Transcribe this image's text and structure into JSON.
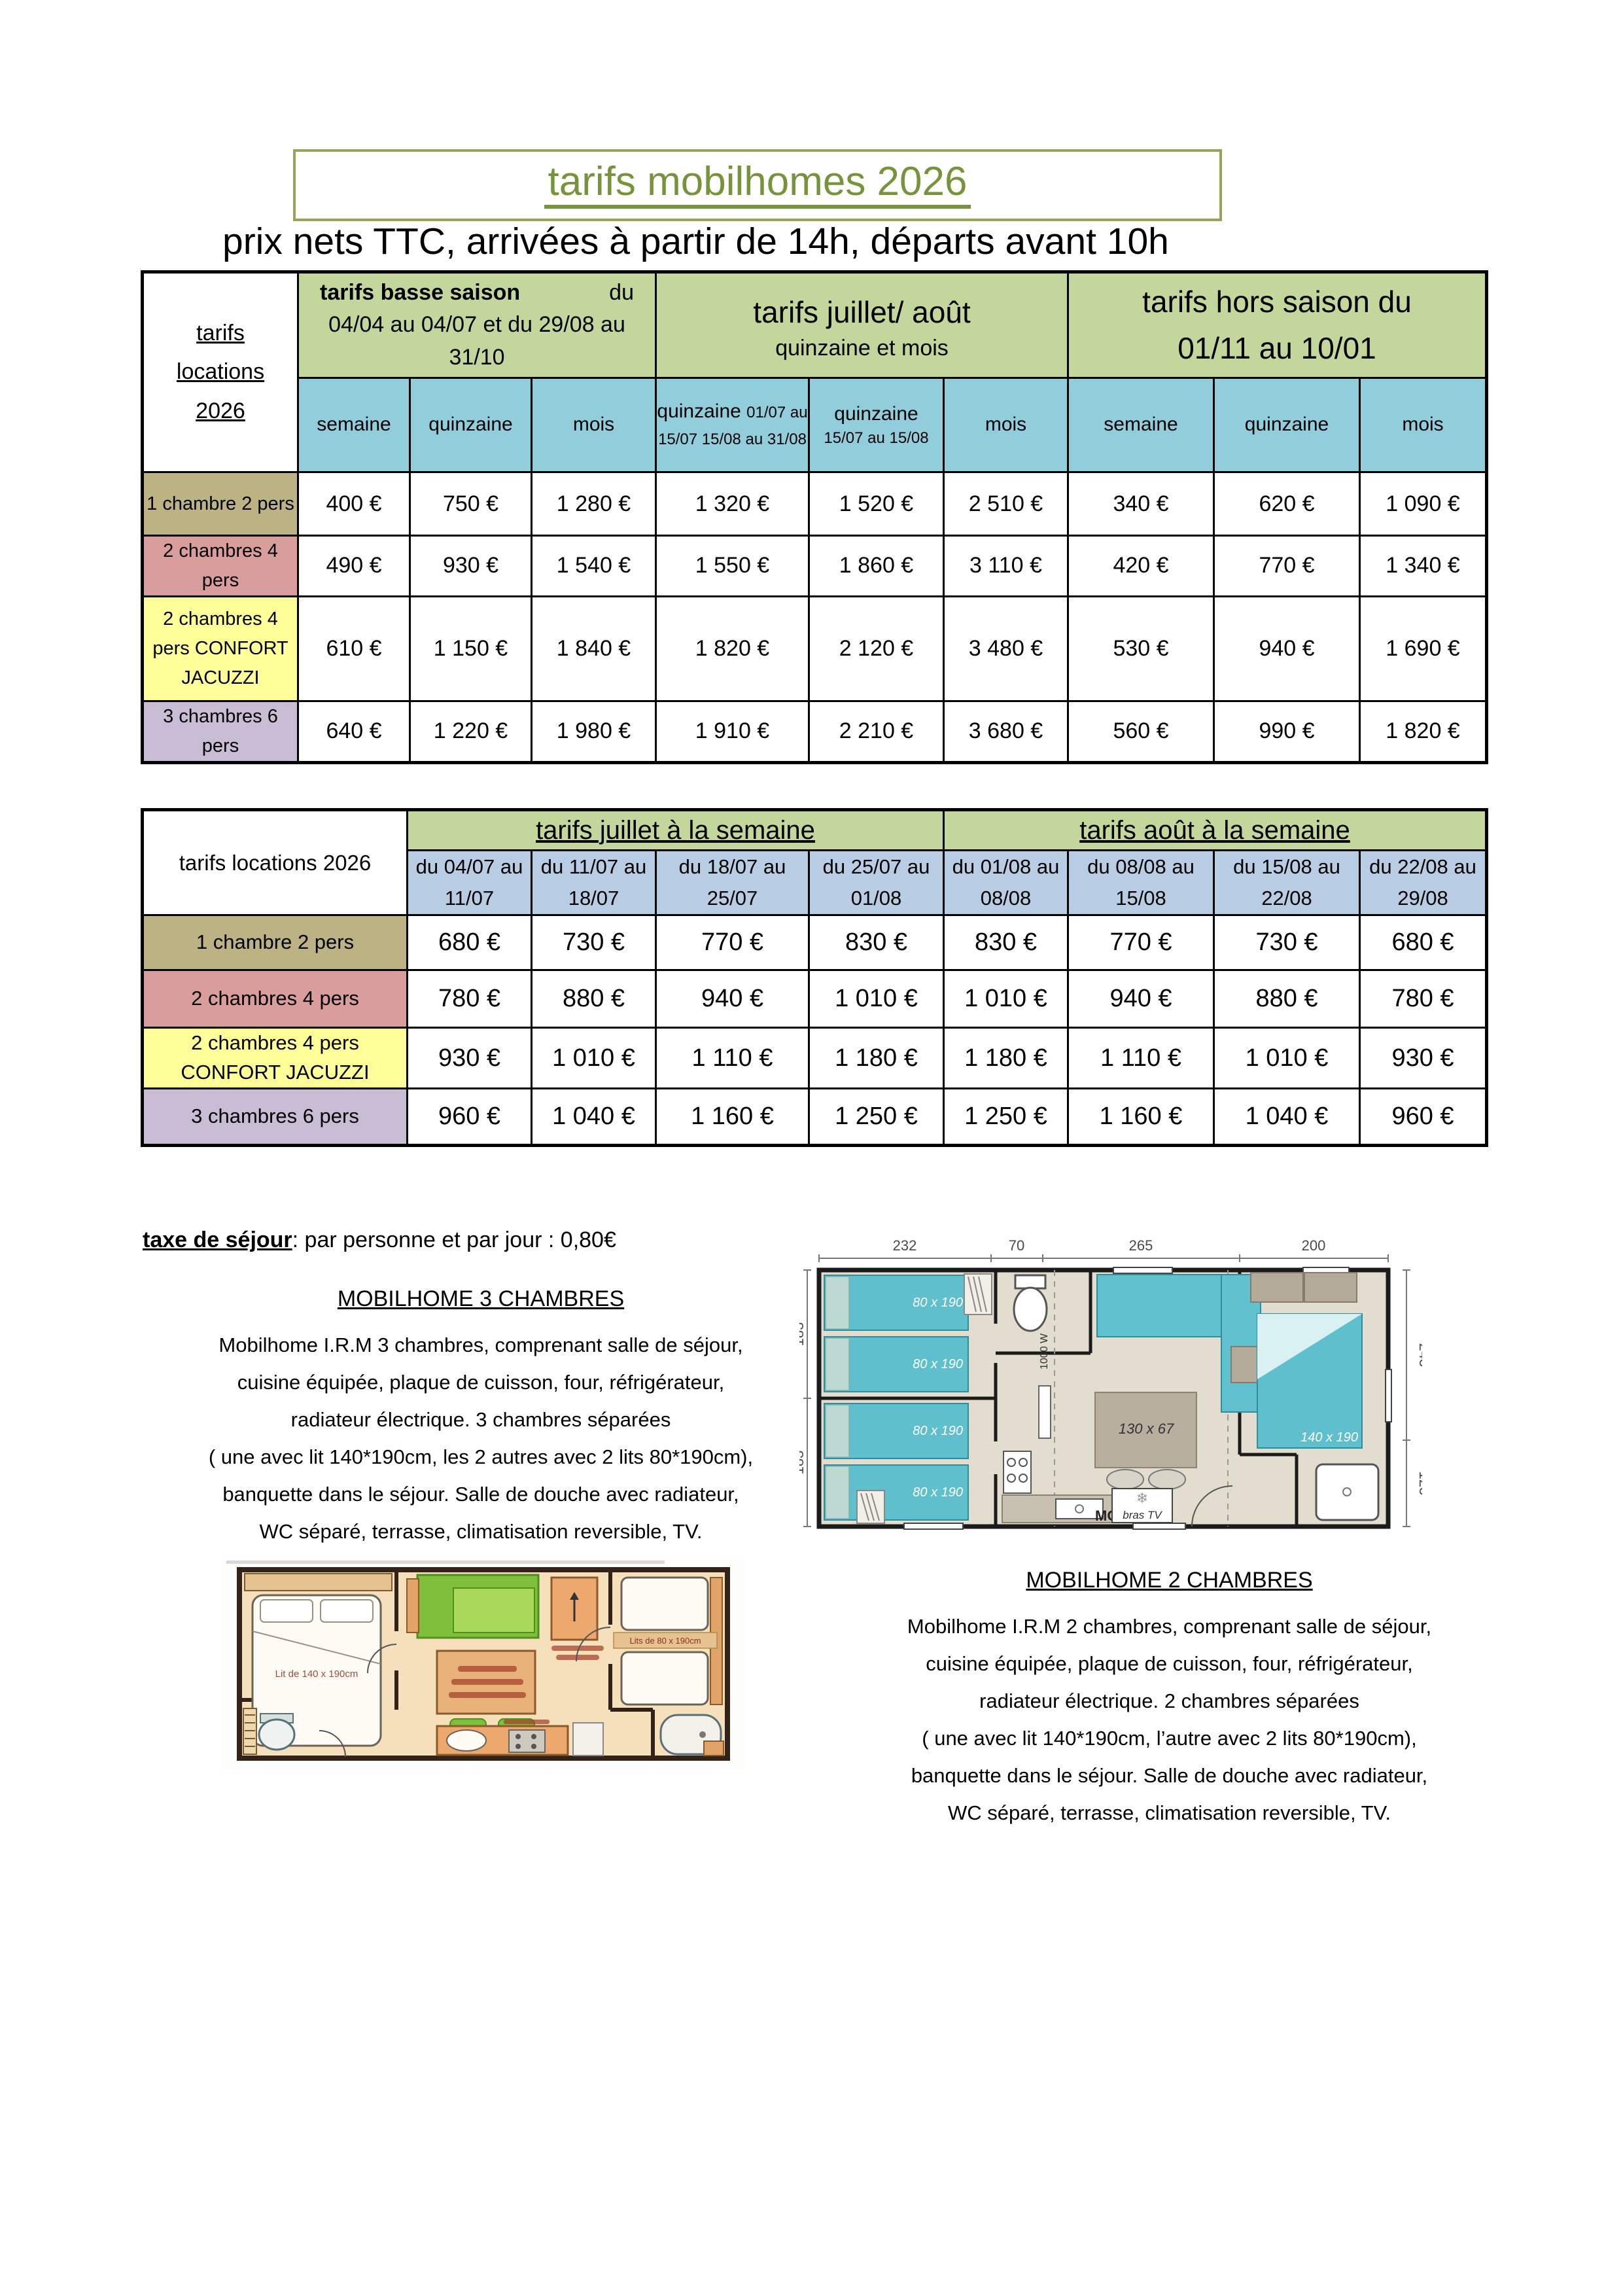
{
  "header": {
    "title": "tarifs mobilhomes 2026",
    "subtitle": "prix nets TTC, arrivées à partir de 14h, départs avant 10h"
  },
  "table1": {
    "corner_lines": [
      "tarifs",
      "locations",
      "2026"
    ],
    "group1_bold": "tarifs basse saison",
    "group1_du": "du",
    "group1_dates": "04/04 au 04/07 et du 29/08 au 31/10",
    "group2_title": "tarifs juillet/ août",
    "group2_sub": "quinzaine et mois",
    "group3_line1": "tarifs hors saison  du",
    "group3_line2": "01/11 au 10/01",
    "col_semaine": "semaine",
    "col_quinzaine": "quinzaine",
    "col_mois": "mois",
    "col_q1_main": "quinzaine",
    "col_q1_detail": "01/07 au 15/07 15/08 au 31/08",
    "col_q2_main": "quinzaine",
    "col_q2_detail": "15/07 au 15/08",
    "rows": [
      {
        "label": "1 chambre 2 pers",
        "values": [
          "400 €",
          "750 €",
          "1 280 €",
          "1 320 €",
          "1 520 €",
          "2 510 €",
          "340 €",
          "620 €",
          "1 090 €"
        ]
      },
      {
        "label": "2 chambres 4 pers",
        "values": [
          "490 €",
          "930 €",
          "1 540 €",
          "1 550 €",
          "1 860 €",
          "3 110 €",
          "420 €",
          "770 €",
          "1 340 €"
        ]
      },
      {
        "label": "2 chambres 4 pers CONFORT JACUZZI",
        "values": [
          "610 €",
          "1 150 €",
          "1 840 €",
          "1 820 €",
          "2 120 €",
          "3 480 €",
          "530 €",
          "940 €",
          "1 690 €"
        ]
      },
      {
        "label": "3 chambres 6 pers",
        "values": [
          "640 €",
          "1 220 €",
          "1 980 €",
          "1 910 €",
          "2 210 €",
          "3 680 €",
          "560 €",
          "990 €",
          "1 820 €"
        ]
      }
    ]
  },
  "table2": {
    "corner": "tarifs locations 2026",
    "juillet_title": "tarifs juillet à la semaine",
    "aout_title": "tarifs août à la semaine",
    "cols": [
      "du 04/07 au 11/07",
      "du 11/07 au 18/07",
      "du 18/07 au 25/07",
      "du 25/07 au 01/08",
      "du 01/08 au 08/08",
      "du 08/08 au 15/08",
      "du 15/08 au 22/08",
      "du 22/08 au 29/08"
    ],
    "rows": [
      {
        "label": "1 chambre 2 pers",
        "values": [
          "680 €",
          "730 €",
          "770 €",
          "830 €",
          "830 €",
          "770 €",
          "730 €",
          "680 €"
        ]
      },
      {
        "label": "2 chambres 4 pers",
        "values": [
          "780 €",
          "880 €",
          "940 €",
          "1 010 €",
          "1 010 €",
          "940 €",
          "880 €",
          "780 €"
        ]
      },
      {
        "label": "2 chambres  4 pers CONFORT JACUZZI",
        "values": [
          "930 €",
          "1 010 €",
          "1 110 €",
          "1 180 €",
          "1 180 €",
          "1 110 €",
          "1 010 €",
          "930 €"
        ]
      },
      {
        "label": "3 chambres 6 pers",
        "values": [
          "960 €",
          "1 040 €",
          "1 160 €",
          "1 250 €",
          "1 250 €",
          "1 160 €",
          "1 040 €",
          "960 €"
        ]
      }
    ]
  },
  "notes": {
    "tax_bold": "taxe de séjour",
    "tax_rest": ": par personne et par jour : 0,80€"
  },
  "mobilhome3": {
    "heading": "MOBILHOME 3 CHAMBRES",
    "lines": [
      "Mobilhome I.R.M 3 chambres, comprenant salle de séjour,",
      "cuisine équipée, plaque de cuisson, four, réfrigérateur,",
      "radiateur électrique. 3 chambres séparées",
      "( une avec lit 140*190cm, les 2 autres avec 2 lits 80*190cm),",
      "banquette dans le séjour. Salle de douche avec radiateur,",
      "WC séparé, terrasse, climatisation reversible, TV."
    ]
  },
  "mobilhome2": {
    "heading": "MOBILHOME 2 CHAMBRES",
    "lines": [
      "Mobilhome I.R.M 2 chambres, comprenant salle de séjour,",
      "cuisine équipée, plaque de cuisson, four, réfrigérateur,",
      "radiateur électrique. 2 chambres séparées",
      "( une avec lit 140*190cm, l’autre avec 2 lits 80*190cm),",
      "banquette dans le séjour. Salle de douche avec radiateur,",
      "WC séparé, terrasse, climatisation reversible, TV."
    ]
  },
  "plan3": {
    "dims_top": [
      "232",
      "70",
      "265",
      "200"
    ],
    "dims_left": [
      "183",
      "183"
    ],
    "dims_right": [
      "243",
      "123"
    ],
    "bed_labels": [
      "80 x 190",
      "80 x 190",
      "80 x 190",
      "80 x 190"
    ],
    "table_label": "130 x 67",
    "big_bed_label": "140 x 190",
    "mo_label": "MO",
    "tv_label": "bras TV",
    "watt_label": "1000 W"
  },
  "plan2": {
    "big_bed_label": "Lit de 140 x 190cm",
    "twin_beds_label": "Lits de 80 x 190cm"
  },
  "colors": {
    "accent_green": "#c3d69b",
    "accent_teal": "#92cddc",
    "accent_periwinkle": "#b8cce4",
    "row_tan": "#bdb283",
    "row_pink": "#d99e9c",
    "row_yellow": "#ffff99",
    "row_purple": "#c8bdd5",
    "title_green": "#77933c"
  }
}
